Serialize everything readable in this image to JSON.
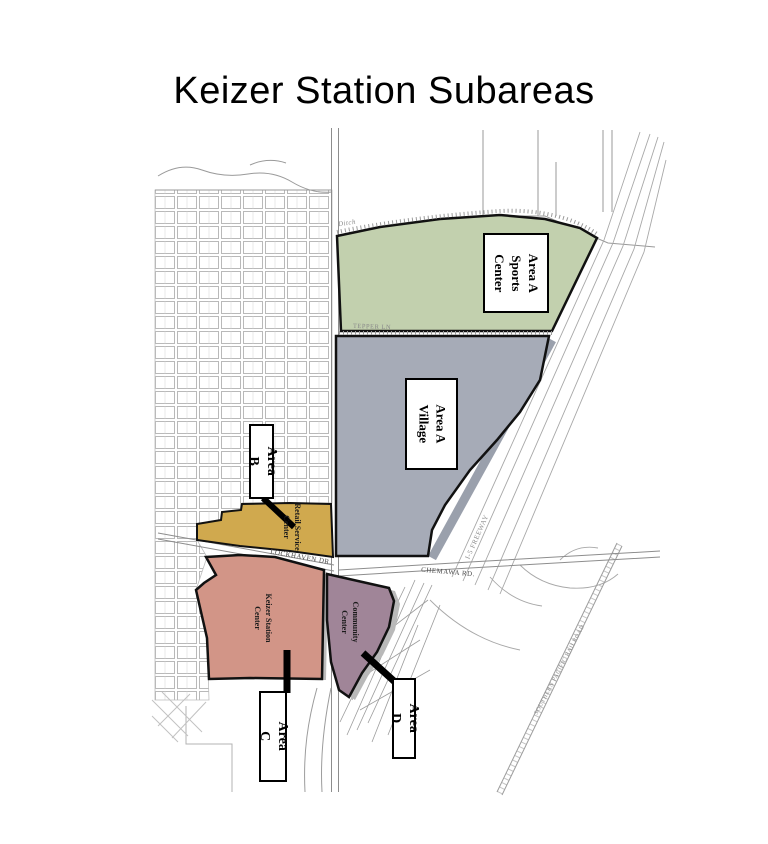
{
  "title": "Keizer Station Subareas",
  "colors": {
    "sports": "#c2d0ae",
    "village": "#a6abb7",
    "retail": "#d0a94e",
    "station": "#d29587",
    "community": "#a08598"
  },
  "areas": {
    "sports": {
      "label": "Area A\nSports\nCenter"
    },
    "village": {
      "label": "Area A\nVillage"
    },
    "b": {
      "label": "Area B"
    },
    "c": {
      "label": "Area C"
    },
    "d": {
      "label": "Area D"
    }
  },
  "region_labels": {
    "retail": "Retail Service\nCenter",
    "station": "Keizer Station\nCenter",
    "community": "Community\nCenter"
  },
  "road_labels": {
    "ditch": "Ditch",
    "tepper": "TEPPER LN",
    "lockhaven": "LOCKHAVEN DR.",
    "chemawa": "CHEMAWA RD.",
    "freeway": "I-5 FREEWAY",
    "railroad": "SOUTHERN PACIFIC RAILROAD"
  }
}
